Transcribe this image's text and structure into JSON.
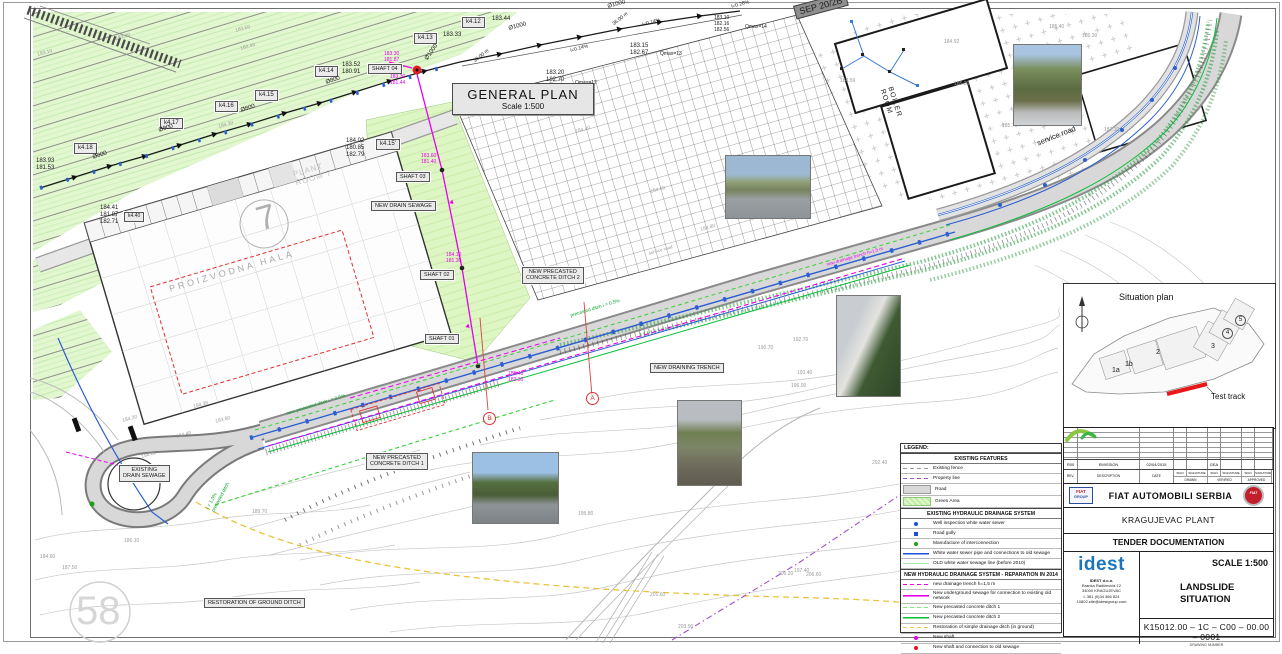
{
  "general_plan": {
    "title": "GENERAL PLAN",
    "scale": "Scale 1:500"
  },
  "colors": {
    "magenta": "#e800e8",
    "green": "#0aa02a",
    "blue": "#2b5fd0",
    "gray": "#9a9a9a",
    "red": "#e03030",
    "yellow": "#ecc23c"
  },
  "legend": {
    "title": "LEGEND:",
    "sections": [
      {
        "header": "EXISTING FEATURES",
        "rows": [
          {
            "swatch": "dash-gray",
            "label": "Existing fence"
          },
          {
            "swatch": "dash-purple",
            "label": "Property line"
          },
          {
            "swatch": "road",
            "label": "Road"
          },
          {
            "swatch": "green-area",
            "label": "Green Area"
          }
        ]
      },
      {
        "header": "EXISTING HYDRAULIC DRAINAGE SYSTEM",
        "rows": [
          {
            "swatch": "dot-blue",
            "label": "Well inspection white water sewer"
          },
          {
            "swatch": "sq-blue",
            "label": "Road gully"
          },
          {
            "swatch": "dot-green",
            "label": "Manufacture of interconnection"
          },
          {
            "swatch": "line-blue",
            "label": "White water sewer pipe and connections to old sewage"
          },
          {
            "swatch": "line-ltgreen",
            "label": "OLD white water sewage line (before 2010)"
          }
        ]
      },
      {
        "header": "NEW HYDRAULIC DRAINAGE SYSTEM - REPARATION IN 2014",
        "rows": [
          {
            "swatch": "dash-magenta",
            "label": "new drainage trench h=1,5 m"
          },
          {
            "swatch": "line-magenta",
            "label": "New underground sewage for connection to existing old network"
          },
          {
            "swatch": "dash-green",
            "label": "New precasted concrete ditch 1"
          },
          {
            "swatch": "line-green",
            "label": "New precasted concrete ditch 2"
          },
          {
            "swatch": "dash-yellow",
            "label": "Restoration of simple drainage ditch (in ground)"
          },
          {
            "swatch": "dot-magenta",
            "label": "New shaft"
          },
          {
            "swatch": "dot-red",
            "label": "New shaft and connection to old sewage"
          }
        ]
      }
    ]
  },
  "situation_plan": {
    "title": "Situation plan",
    "test_track": "Test track",
    "zones": [
      {
        "t": "1a",
        "x": 48,
        "y": 83,
        "circled": false
      },
      {
        "t": "1b",
        "x": 61,
        "y": 77,
        "circled": false
      },
      {
        "t": "2",
        "x": 92,
        "y": 65,
        "circled": false
      },
      {
        "t": "3",
        "x": 147,
        "y": 59,
        "circled": false
      },
      {
        "t": "4",
        "x": 158,
        "y": 44,
        "circled": true
      },
      {
        "t": "5",
        "x": 171,
        "y": 31,
        "circled": true
      }
    ]
  },
  "title_block": {
    "revision": {
      "values": [
        "R00",
        "EMISSION",
        "02/04/2015",
        "",
        "",
        "GEA",
        "",
        "",
        ""
      ],
      "rev_h": "REV.",
      "desc_h": "DESCRIPTION",
      "date_h": "DATE",
      "sign_h": "SIGN",
      "signature_h": "SIGNATURE",
      "drawn_h": "DRAWN",
      "verified_h": "VERIFIED",
      "approved_h": "APPROVED"
    },
    "company": "FIAT AUTOMOBILI SERBIA",
    "plant": "KRAGUJEVAC PLANT",
    "document": "TENDER DOCUMENTATION",
    "scale": "SCALE 1:500",
    "drawing_title_line1": "LANDSLIDE",
    "drawing_title_line2": "SITUATION",
    "drawing_number": "K15012.00 – 1C –  C00  –  00.00  –  0001",
    "drawing_number_caption": "DRAWING NUMBER",
    "logos": {
      "fiat_group_top": "FIAT",
      "fiat_group_bottom": "GROUP",
      "fiat_badge": "FIAT",
      "idest": "idest"
    },
    "address": [
      "IDEST d.o.o.",
      "Branka Radičevića 12",
      "34000 KRAGUJEVAC",
      "t. 381 (0)34 366 824",
      "10802.site@idestgroup.com"
    ]
  },
  "photos": [
    {
      "name": "photo-road-median",
      "kind": "road",
      "x": 725,
      "y": 155,
      "w": 84,
      "h": 62
    },
    {
      "name": "photo-hillside",
      "kind": "hill",
      "x": 1013,
      "y": 44,
      "w": 67,
      "h": 80
    },
    {
      "name": "photo-retaining-wall",
      "kind": "wall",
      "x": 836,
      "y": 295,
      "w": 63,
      "h": 100
    },
    {
      "name": "photo-drain-ditch",
      "kind": "ditch",
      "x": 677,
      "y": 400,
      "w": 63,
      "h": 84
    },
    {
      "name": "photo-highway-slope",
      "kind": "highway",
      "x": 472,
      "y": 452,
      "w": 85,
      "h": 70
    }
  ],
  "section_markers": [
    {
      "t": "A",
      "x": 586,
      "y": 392
    },
    {
      "t": "B",
      "x": 483,
      "y": 412
    }
  ],
  "annotations": [
    {
      "t": "k4.12",
      "x": 462,
      "y": 17,
      "box": true,
      "n": "label-k4-12"
    },
    {
      "t": "k4.13",
      "x": 414,
      "y": 33,
      "box": true,
      "n": "label-k4-13"
    },
    {
      "t": "k4.14",
      "x": 315,
      "y": 66,
      "box": true,
      "n": "label-k4-14"
    },
    {
      "t": "k4.15",
      "x": 255,
      "y": 90,
      "box": true,
      "n": "label-k4-15"
    },
    {
      "t": "k4.16",
      "x": 215,
      "y": 101,
      "box": true,
      "n": "label-k4-16"
    },
    {
      "t": "k4.17",
      "x": 160,
      "y": 118,
      "box": true,
      "n": "label-k4-17"
    },
    {
      "t": "k4.18",
      "x": 74,
      "y": 143,
      "box": true,
      "n": "label-k4-18"
    },
    {
      "t": "k4.15'",
      "x": 376,
      "y": 139,
      "box": true,
      "n": "label-k4-15p"
    },
    {
      "t": "k4.40",
      "x": 124,
      "y": 212,
      "s": 5,
      "box": true,
      "n": "label-k4-40"
    },
    {
      "t": "SHAFT 04",
      "x": 368,
      "y": 64,
      "s": 5.5,
      "box": true,
      "n": "label-shaft-04"
    },
    {
      "t": "SHAFT 03",
      "x": 396,
      "y": 172,
      "s": 5.5,
      "box": true,
      "n": "label-shaft-03"
    },
    {
      "t": "SHAFT 02",
      "x": 420,
      "y": 270,
      "s": 5.5,
      "box": true,
      "n": "label-shaft-02"
    },
    {
      "t": "SHAFT 01",
      "x": 425,
      "y": 334,
      "s": 5.5,
      "box": true,
      "n": "label-shaft-01"
    },
    {
      "t": "NEW DRAIN SEWAGE",
      "x": 371,
      "y": 201,
      "s": 5.5,
      "box": true,
      "n": "label-new-drain-sewage"
    },
    {
      "t": "NEW PRECASTED\nCONCRETE DITCH 2",
      "x": 522,
      "y": 267,
      "s": 5.5,
      "box": true,
      "multi": true,
      "n": "label-ditch-2"
    },
    {
      "t": "NEW PRECASTED\nCONCRETE DITCH 1",
      "x": 366,
      "y": 453,
      "s": 5.5,
      "box": true,
      "multi": true,
      "n": "label-ditch-1"
    },
    {
      "t": "NEW DRAINING TRENCH",
      "x": 650,
      "y": 363,
      "s": 5.5,
      "box": true,
      "n": "label-draining-trench"
    },
    {
      "t": "EXISTING\nDRAIN SEWAGE",
      "x": 119,
      "y": 465,
      "s": 5.5,
      "box": true,
      "multi": true,
      "n": "label-existing-drain-sewage"
    },
    {
      "t": "RESTORATION OF GROUND DITCH",
      "x": 204,
      "y": 598,
      "s": 5.5,
      "box": true,
      "n": "label-restoration-ditch"
    },
    {
      "t": "SEP 20/2B",
      "x": 793,
      "y": 6,
      "r": -15,
      "dark": true,
      "n": "label-sep"
    },
    {
      "t": "183.44",
      "x": 492,
      "y": 16,
      "n": "elevation-label"
    },
    {
      "t": "183.33",
      "x": 443,
      "y": 32,
      "n": "elevation-label"
    },
    {
      "t": "183.52\n180.91",
      "x": 342,
      "y": 62,
      "multi": true,
      "n": "elevation-label"
    },
    {
      "t": "183.93\n181.53",
      "x": 36,
      "y": 158,
      "multi": true,
      "n": "elevation-label"
    },
    {
      "t": "184.02\n180.85\n182.79",
      "x": 346,
      "y": 138,
      "multi": true,
      "n": "elevation-label"
    },
    {
      "t": "184.41\n181.87\n182.71",
      "x": 100,
      "y": 205,
      "multi": true,
      "n": "elevation-label"
    },
    {
      "t": "183.20\n182.70",
      "x": 546,
      "y": 70,
      "multi": true,
      "n": "elevation-label"
    },
    {
      "t": "Qmax=12",
      "x": 575,
      "y": 81,
      "s": 5,
      "n": "flow-label"
    },
    {
      "t": "183.15\n182.67",
      "x": 630,
      "y": 43,
      "multi": true,
      "n": "elevation-label"
    },
    {
      "t": "Qmax=13",
      "x": 660,
      "y": 52,
      "s": 5,
      "n": "flow-label"
    },
    {
      "t": "183.10\n182.16\n182.56",
      "x": 714,
      "y": 16,
      "s": 5,
      "multi": true,
      "n": "elevation-label"
    },
    {
      "t": "Qmax=14",
      "x": 745,
      "y": 25,
      "s": 5,
      "n": "flow-label"
    },
    {
      "t": "Ø1000",
      "x": 424,
      "y": 58,
      "r": -55,
      "n": "pipe-diameter-label"
    },
    {
      "t": "Ø1000",
      "x": 508,
      "y": 26,
      "r": -15,
      "n": "pipe-diameter-label"
    },
    {
      "t": "Ø1000",
      "x": 607,
      "y": 4,
      "r": -15,
      "n": "pipe-diameter-label"
    },
    {
      "t": "Ø800",
      "x": 325,
      "y": 80,
      "r": -18,
      "n": "pipe-diameter-label"
    },
    {
      "t": "Ø800",
      "x": 240,
      "y": 108,
      "r": -18,
      "n": "pipe-diameter-label"
    },
    {
      "t": "Ø800",
      "x": 158,
      "y": 128,
      "r": -18,
      "n": "pipe-diameter-label"
    },
    {
      "t": "Ø800",
      "x": 92,
      "y": 155,
      "r": -18,
      "n": "pipe-diameter-label"
    },
    {
      "t": "i=0.14%",
      "x": 570,
      "y": 49,
      "r": -15,
      "s": 5,
      "n": "slope-label"
    },
    {
      "t": "i=0.14%",
      "x": 642,
      "y": 23,
      "r": -15,
      "s": 5,
      "n": "slope-label"
    },
    {
      "t": "i=0.28%",
      "x": 731,
      "y": 5,
      "r": -15,
      "s": 5,
      "n": "slope-label"
    },
    {
      "t": "36.00 m",
      "x": 473,
      "y": 60,
      "r": -38,
      "s": 5,
      "n": "distance-label"
    },
    {
      "t": "36.00 m",
      "x": 612,
      "y": 23,
      "r": -38,
      "s": 5,
      "n": "distance-label"
    },
    {
      "t": "183.30\n181.87",
      "x": 384,
      "y": 52,
      "c": "#e800e8",
      "s": 5,
      "multi": true,
      "n": "elevation-label"
    },
    {
      "t": "183.30\n181.44",
      "x": 390,
      "y": 75,
      "c": "#e800e8",
      "s": 5,
      "multi": true,
      "n": "elevation-label"
    },
    {
      "t": "183.60\n181.40",
      "x": 421,
      "y": 154,
      "c": "#e800e8",
      "s": 5,
      "multi": true,
      "n": "elevation-label"
    },
    {
      "t": "184.10\n181.30",
      "x": 446,
      "y": 253,
      "c": "#e800e8",
      "s": 5,
      "multi": true,
      "n": "elevation-label"
    },
    {
      "t": "185.40\n182.30",
      "x": 508,
      "y": 372,
      "c": "#e800e8",
      "s": 5,
      "multi": true,
      "n": "elevation-label"
    },
    {
      "t": "new drainage trench h=1.5 m",
      "x": 826,
      "y": 262,
      "c": "#e800e8",
      "r": -16,
      "s": 4.5,
      "n": "trench-label"
    },
    {
      "t": "new precasted ditch i = 0.5%",
      "x": 286,
      "y": 412,
      "c": "#0aa02a",
      "r": -17,
      "s": 4.8,
      "n": "ditch-slope-label"
    },
    {
      "t": "precasted ditch i = 0.5%",
      "x": 570,
      "y": 314,
      "c": "#0aa02a",
      "r": -17,
      "s": 4.8,
      "n": "ditch-slope-label"
    },
    {
      "t": "i = 1.0%\nprecasted ditch",
      "x": 206,
      "y": 508,
      "c": "#0aa02a",
      "r": -62,
      "s": 4.8,
      "multi": true,
      "n": "ditch-slope-label"
    },
    {
      "t": "▲",
      "x": 449,
      "y": 198,
      "c": "#e800e8",
      "s": 7,
      "r": 10,
      "n": "flow-arrow"
    },
    {
      "t": "▲",
      "x": 465,
      "y": 322,
      "c": "#e800e8",
      "s": 7,
      "r": 10,
      "n": "flow-arrow"
    },
    {
      "t": "183.10",
      "x": 37,
      "y": 53,
      "c": "#9a9a9a",
      "s": 5,
      "r": -15,
      "n": "elevation-label"
    },
    {
      "t": "183.40",
      "x": 115,
      "y": 37,
      "c": "#9a9a9a",
      "s": 5,
      "r": -15,
      "n": "elevation-label"
    },
    {
      "t": "183.50",
      "x": 235,
      "y": 29,
      "c": "#9a9a9a",
      "s": 5,
      "r": -15,
      "n": "elevation-label"
    },
    {
      "t": "183.40",
      "x": 240,
      "y": 47,
      "c": "#9a9a9a",
      "s": 5,
      "r": -15,
      "n": "elevation-label"
    },
    {
      "t": "184.30",
      "x": 218,
      "y": 125,
      "c": "#9a9a9a",
      "s": 5,
      "r": -15,
      "n": "elevation-label"
    },
    {
      "t": "184.40",
      "x": 575,
      "y": 130,
      "c": "#9a9a9a",
      "s": 5,
      "r": -15,
      "n": "elevation-label"
    },
    {
      "t": "184.60",
      "x": 650,
      "y": 190,
      "c": "#9a9a9a",
      "s": 5,
      "r": -15,
      "n": "elevation-label"
    },
    {
      "t": "184.80",
      "x": 700,
      "y": 228,
      "c": "#9a9a9a",
      "s": 5,
      "r": -15,
      "n": "elevation-label"
    },
    {
      "t": "184.92",
      "x": 944,
      "y": 40,
      "c": "#9a9a9a",
      "s": 5,
      "n": "elevation-label"
    },
    {
      "t": "184.59",
      "x": 840,
      "y": 79,
      "c": "#9a9a9a",
      "s": 5,
      "n": "elevation-label"
    },
    {
      "t": "185.30",
      "x": 954,
      "y": 82,
      "c": "#9a9a9a",
      "s": 5,
      "n": "elevation-label"
    },
    {
      "t": "185.70",
      "x": 1002,
      "y": 124,
      "c": "#9a9a9a",
      "s": 5,
      "n": "elevation-label"
    },
    {
      "t": "185.40",
      "x": 1049,
      "y": 25,
      "c": "#9a9a9a",
      "s": 5,
      "n": "elevation-label"
    },
    {
      "t": "186.30",
      "x": 1082,
      "y": 34,
      "c": "#9a9a9a",
      "s": 5,
      "n": "elevation-label"
    },
    {
      "t": "187.10",
      "x": 1104,
      "y": 128,
      "c": "#9a9a9a",
      "s": 5,
      "n": "elevation-label"
    },
    {
      "t": "184.20",
      "x": 122,
      "y": 419,
      "c": "#9a9a9a",
      "s": 5,
      "r": -15,
      "n": "elevation-label"
    },
    {
      "t": "183.80",
      "x": 215,
      "y": 420,
      "c": "#9a9a9a",
      "s": 5,
      "r": -15,
      "n": "elevation-label"
    },
    {
      "t": "184.30",
      "x": 193,
      "y": 405,
      "c": "#9a9a9a",
      "s": 5,
      "r": -15,
      "n": "elevation-label"
    },
    {
      "t": "184.40",
      "x": 176,
      "y": 435,
      "c": "#9a9a9a",
      "s": 5,
      "r": -15,
      "n": "elevation-label"
    },
    {
      "t": "184.80",
      "x": 141,
      "y": 455,
      "c": "#9a9a9a",
      "s": 5,
      "r": -15,
      "n": "elevation-label"
    },
    {
      "t": "186.10",
      "x": 124,
      "y": 539,
      "c": "#9a9a9a",
      "s": 5,
      "n": "elevation-label"
    },
    {
      "t": "184.60",
      "x": 40,
      "y": 555,
      "c": "#9a9a9a",
      "s": 5,
      "n": "elevation-label"
    },
    {
      "t": "187.50",
      "x": 62,
      "y": 566,
      "c": "#9a9a9a",
      "s": 5,
      "n": "elevation-label"
    },
    {
      "t": "189.70",
      "x": 252,
      "y": 510,
      "c": "#9a9a9a",
      "s": 5,
      "n": "contour-label"
    },
    {
      "t": "190.70",
      "x": 758,
      "y": 346,
      "c": "#9a9a9a",
      "s": 5,
      "n": "contour-label"
    },
    {
      "t": "192.70",
      "x": 793,
      "y": 338,
      "c": "#9a9a9a",
      "s": 5,
      "n": "contour-label"
    },
    {
      "t": "193.40",
      "x": 797,
      "y": 371,
      "c": "#9a9a9a",
      "s": 5,
      "n": "contour-label"
    },
    {
      "t": "196.00",
      "x": 791,
      "y": 384,
      "c": "#9a9a9a",
      "s": 5,
      "n": "contour-label"
    },
    {
      "t": "195.80",
      "x": 578,
      "y": 512,
      "c": "#9a9a9a",
      "s": 5,
      "n": "contour-label"
    },
    {
      "t": "197.40",
      "x": 794,
      "y": 569,
      "c": "#9a9a9a",
      "s": 5,
      "n": "contour-label"
    },
    {
      "t": "201.60",
      "x": 650,
      "y": 593,
      "c": "#9a9a9a",
      "s": 5,
      "n": "contour-label"
    },
    {
      "t": "202.40",
      "x": 872,
      "y": 461,
      "c": "#9a9a9a",
      "s": 5,
      "n": "contour-label"
    },
    {
      "t": "206.20",
      "x": 778,
      "y": 572,
      "c": "#9a9a9a",
      "s": 5,
      "n": "contour-label"
    },
    {
      "t": "206.60",
      "x": 806,
      "y": 573,
      "c": "#9a9a9a",
      "s": 5,
      "n": "contour-label"
    },
    {
      "t": "203.90",
      "x": 678,
      "y": 625,
      "c": "#9a9a9a",
      "s": 5,
      "n": "contour-label"
    },
    {
      "t": "PROIZVODNA  HALA",
      "x": 168,
      "y": 284,
      "c": "#a8a8a8",
      "s": 9,
      "r": -16,
      "ls": 3,
      "n": "area-label-proizvodna-hala"
    },
    {
      "t": "PLANT\nROOM 7",
      "x": 292,
      "y": 170,
      "c": "#c4c4c4",
      "s": 8,
      "r": -16,
      "ls": 1,
      "multi": true,
      "n": "area-label-plant-room-7"
    },
    {
      "t": "BOILER\nROOM",
      "x": 893,
      "y": 86,
      "c": "#1a1a1a",
      "s": 7,
      "r": 72,
      "multi": true,
      "ls": 1,
      "n": "area-label-boiler-room"
    },
    {
      "t": "service road",
      "x": 1036,
      "y": 140,
      "c": "#111",
      "s": 7.5,
      "r": -22,
      "n": "area-label-service-road"
    },
    {
      "t": "service road",
      "x": 648,
      "y": 251,
      "c": "#999",
      "s": 4.5,
      "r": -16,
      "n": "area-label-service-road-small"
    },
    {
      "t": "7",
      "x": 252,
      "y": 202,
      "c": "#b0b0b0",
      "s": 34,
      "r": -16,
      "n": "building-number-7"
    },
    {
      "t": "58",
      "x": 76,
      "y": 588,
      "c": "#d6d6d6",
      "s": 40,
      "n": "watermark-58"
    }
  ]
}
